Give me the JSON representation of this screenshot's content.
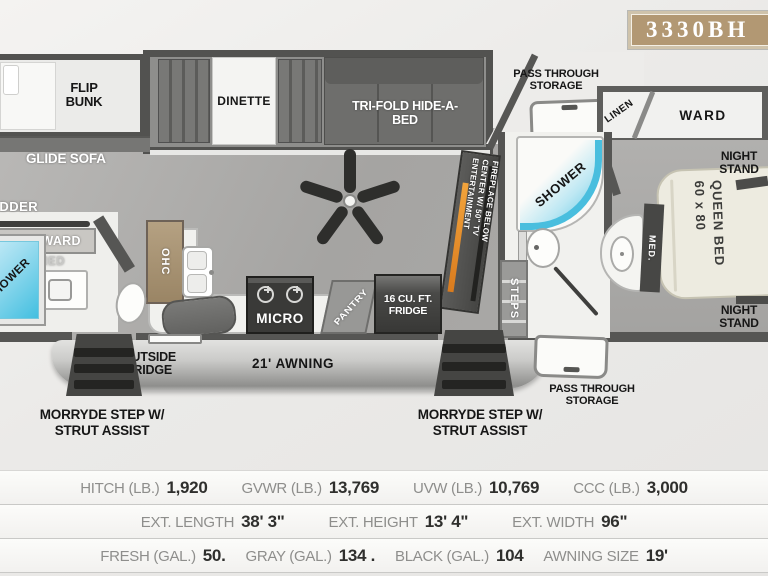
{
  "badge": {
    "model": "3330BH"
  },
  "plan": {
    "flip_bunk": "FLIP BUNK",
    "glide_sofa": "GLIDE SOFA",
    "ladder": "LADDER",
    "cabinet_ward": "CABINET/WARD",
    "med_rear": "MED",
    "shower_rear": "SHOWER",
    "dinette": "DINETTE",
    "tri_fold": "TRI-FOLD HIDE-A-BED",
    "ohc": "OHC",
    "micro": "MICRO",
    "pantry": "PANTRY",
    "fridge": "16 CU. FT. FRIDGE",
    "outside_fridge": "OUTSIDE FRIDGE",
    "awning": "21' AWNING",
    "pass_through_top": "PASS THROUGH STORAGE",
    "pass_through_bottom": "PASS THROUGH STORAGE",
    "linen": "LINEN",
    "ward": "WARD",
    "shower_main": "SHOWER",
    "steps": "STEPS",
    "ent_center": {
      "line1": "ENTERTAINMENT",
      "line2": "CENTER W/ 50\" TV",
      "line3": "FIREPLACE BELOW"
    },
    "night_stand_top": "NIGHT STAND",
    "night_stand_bottom": "NIGHT STAND",
    "queen_bed": {
      "size": "60 x 80",
      "name": "QUEEN BED"
    },
    "med_front": "MED.",
    "morryde_left": "MORRYDE STEP W/ STRUT ASSIST",
    "morryde_right": "MORRYDE STEP W/ STRUT ASSIST"
  },
  "colors": {
    "badge_bg": "#b29873",
    "shower_blue": "#49bede",
    "fireplace_orange": "#e8922a"
  },
  "specs": {
    "rows": [
      {
        "items": [
          {
            "label": "HITCH (LB.)",
            "value": "1,920"
          },
          {
            "label": "GVWR (LB.)",
            "value": "13,769"
          },
          {
            "label": "UVW (LB.)",
            "value": "10,769"
          },
          {
            "label": "CCC (LB.)",
            "value": "3,000"
          }
        ]
      },
      {
        "items": [
          {
            "label": "EXT. LENGTH",
            "value": "38' 3\""
          },
          {
            "label": "EXT. HEIGHT",
            "value": "13' 4\""
          },
          {
            "label": "EXT. WIDTH",
            "value": "96\""
          }
        ]
      },
      {
        "items": [
          {
            "label": "FRESH (GAL.)",
            "value": "50."
          },
          {
            "label": "GRAY (GAL.)",
            "value": "134 ."
          },
          {
            "label": "BLACK (GAL.)",
            "value": "104"
          },
          {
            "label": "AWNING SIZE",
            "value": "19'"
          }
        ]
      }
    ]
  }
}
